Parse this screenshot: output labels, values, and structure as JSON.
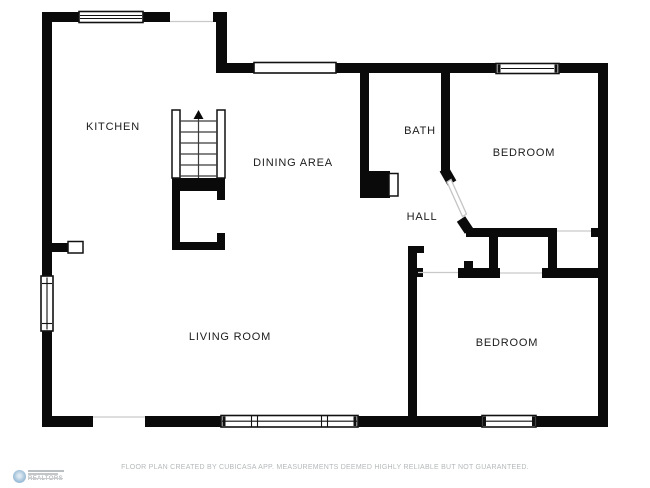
{
  "rooms": {
    "kitchen": "KITCHEN",
    "dining_area": "DINING AREA",
    "bath": "BATH",
    "bedroom_top": "BEDROOM",
    "hall": "HALL",
    "living_room": "LIVING ROOM",
    "bedroom_bottom": "BEDROOM"
  },
  "footer": {
    "disclaimer": "FLOOR PLAN CREATED BY CUBICASA APP. MEASUREMENTS DEEMED HIGHLY RELIABLE BUT NOT GUARANTEED."
  },
  "logo": {
    "text": "REALTORS"
  },
  "icons": {
    "stairs_direction": "up-arrow"
  },
  "colors": {
    "wall": "#0a0a0a",
    "label": "#1c1c1c",
    "footer_text": "#b4b8ba",
    "opening_line": "#c9c9c9",
    "logo_blue": "#a0c0d8"
  }
}
